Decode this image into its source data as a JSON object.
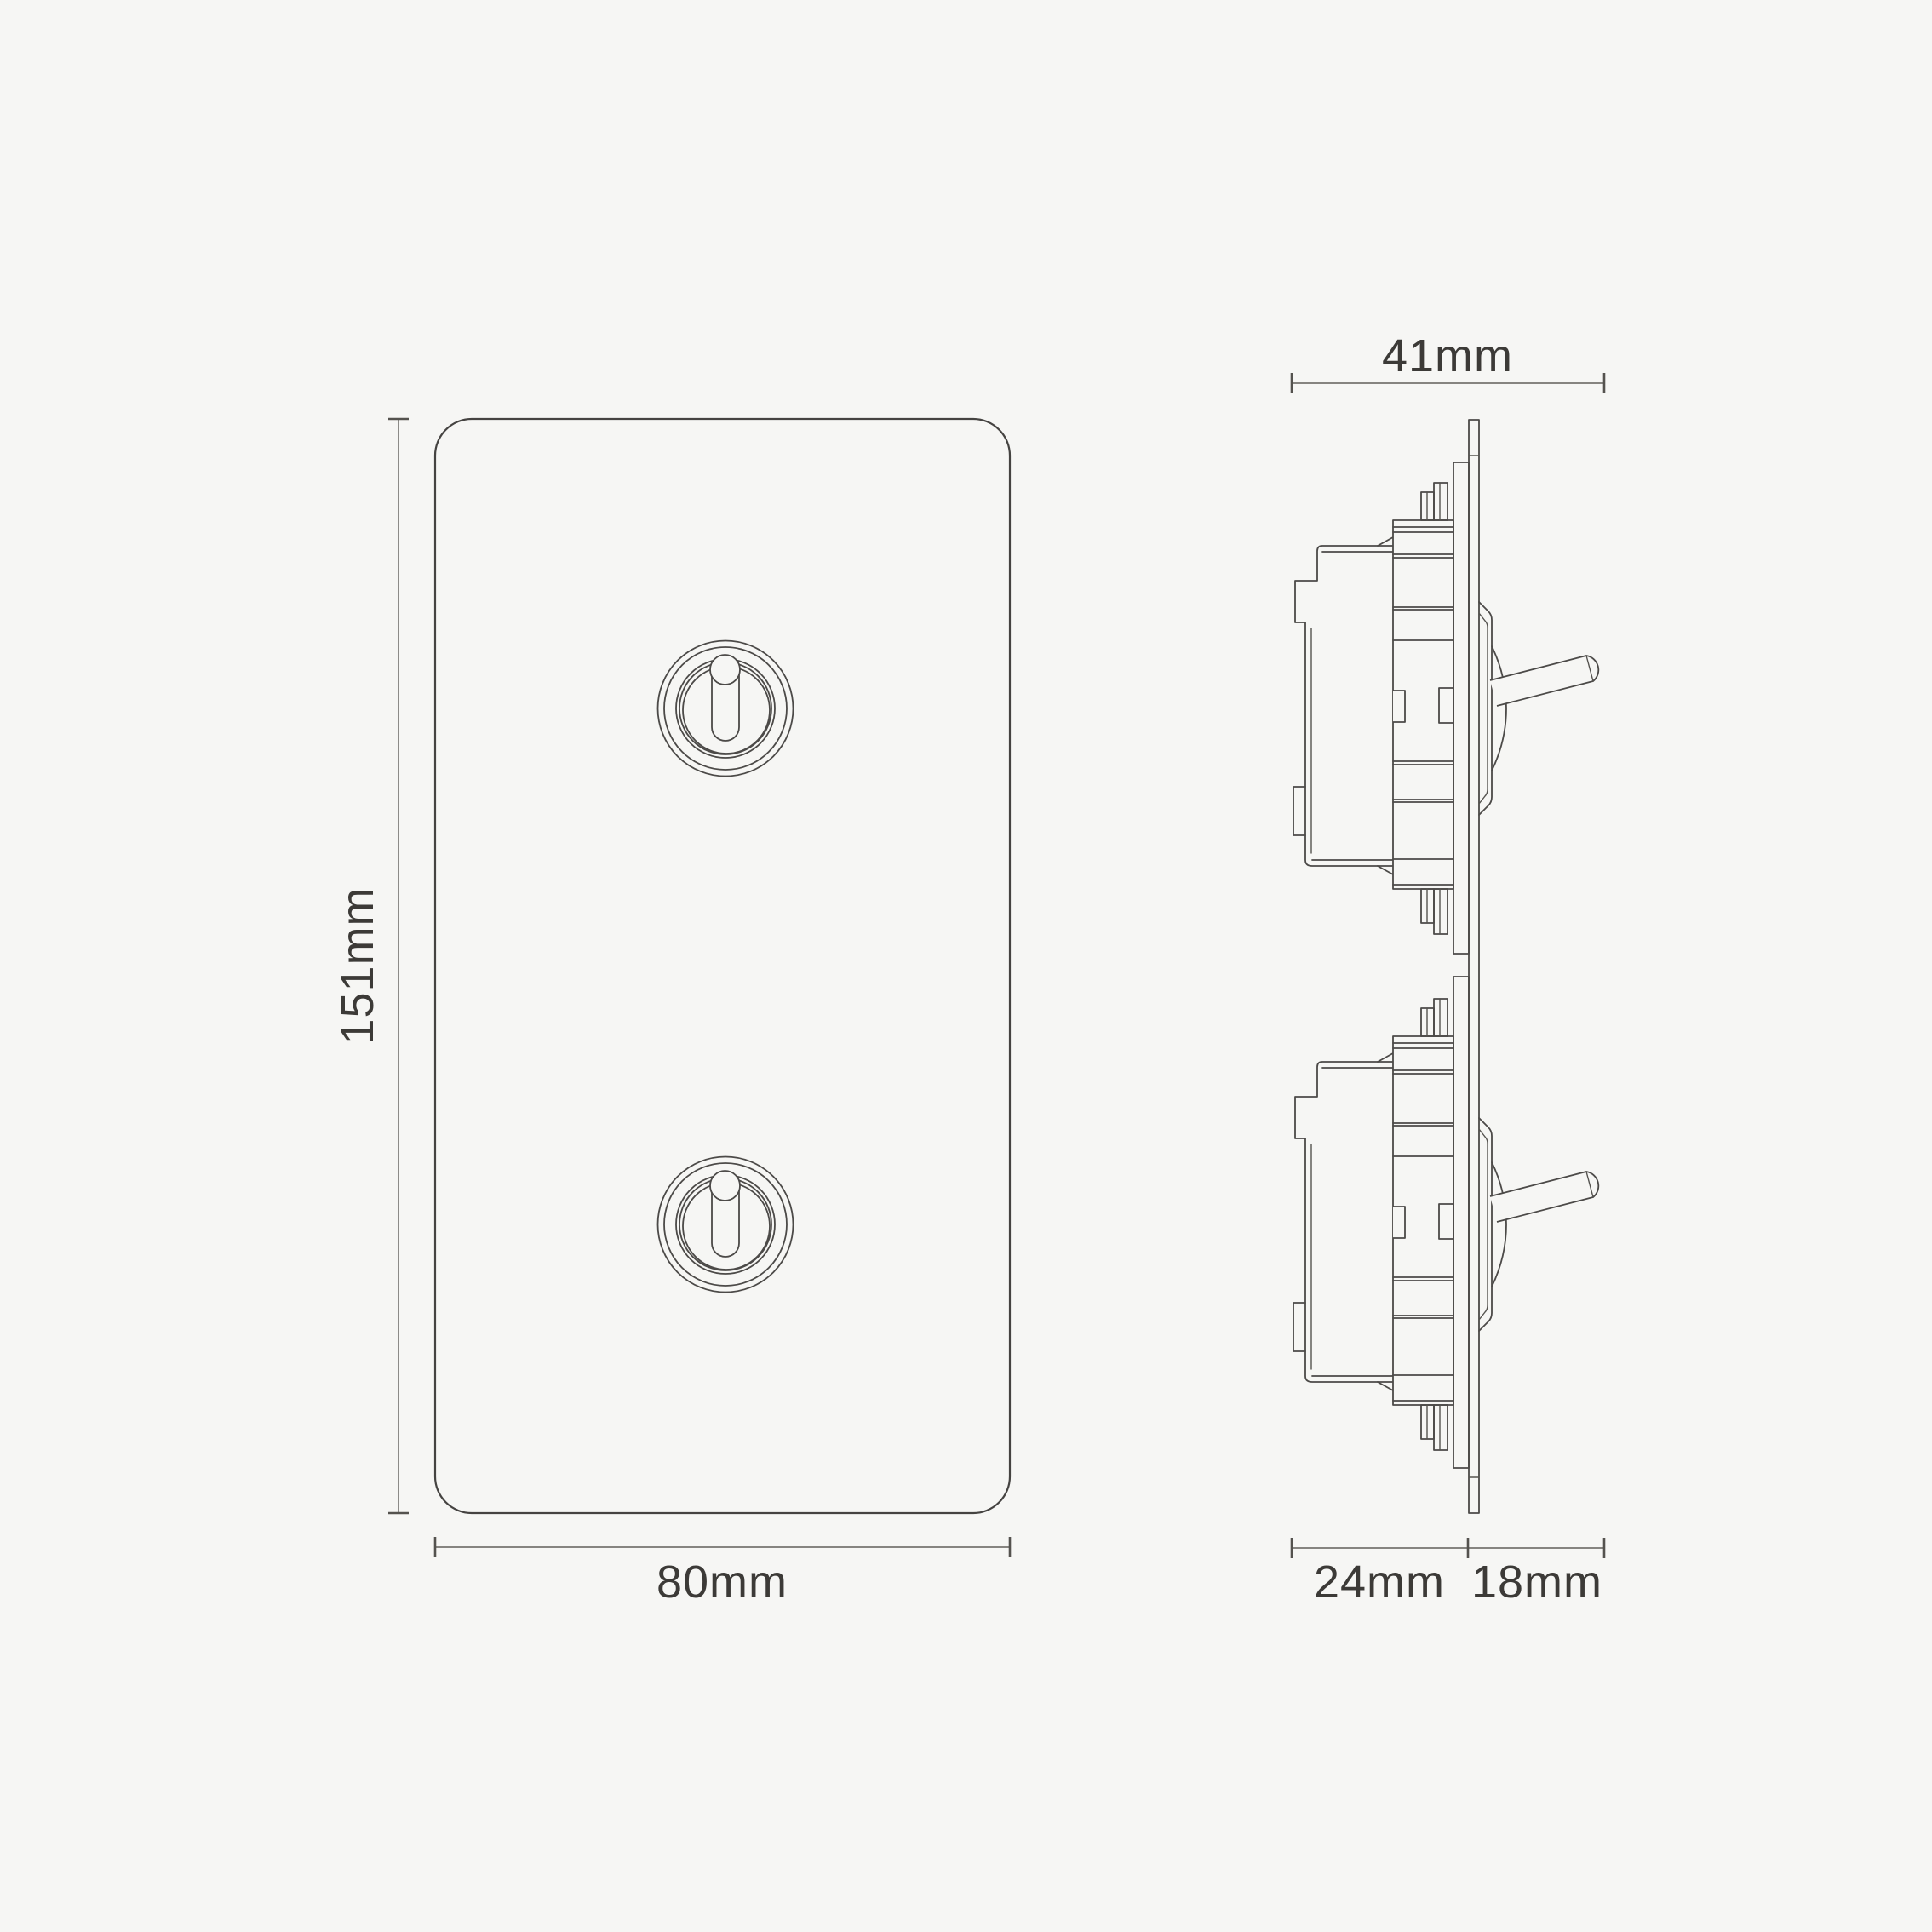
{
  "page": {
    "background": "#f6f6f4",
    "description": "Technical dimension drawing of a 2-gang vertical toggle light switch, front elevation and side elevation"
  },
  "drawing": {
    "colors": {
      "line": "#4c4a48",
      "dimension_line": "#605e5a",
      "label_text": "#3c3a37"
    },
    "dimensions": {
      "overall_depth": {
        "label": "41mm",
        "value": 41,
        "unit": "mm"
      },
      "plate_height": {
        "label": "151mm",
        "value": 151,
        "unit": "mm"
      },
      "plate_width": {
        "label": "80mm",
        "value": 80,
        "unit": "mm"
      },
      "depth_behind_plate": {
        "label": "24mm",
        "value": 24,
        "unit": "mm"
      },
      "depth_in_front": {
        "label": "18mm",
        "value": 18,
        "unit": "mm"
      }
    }
  }
}
